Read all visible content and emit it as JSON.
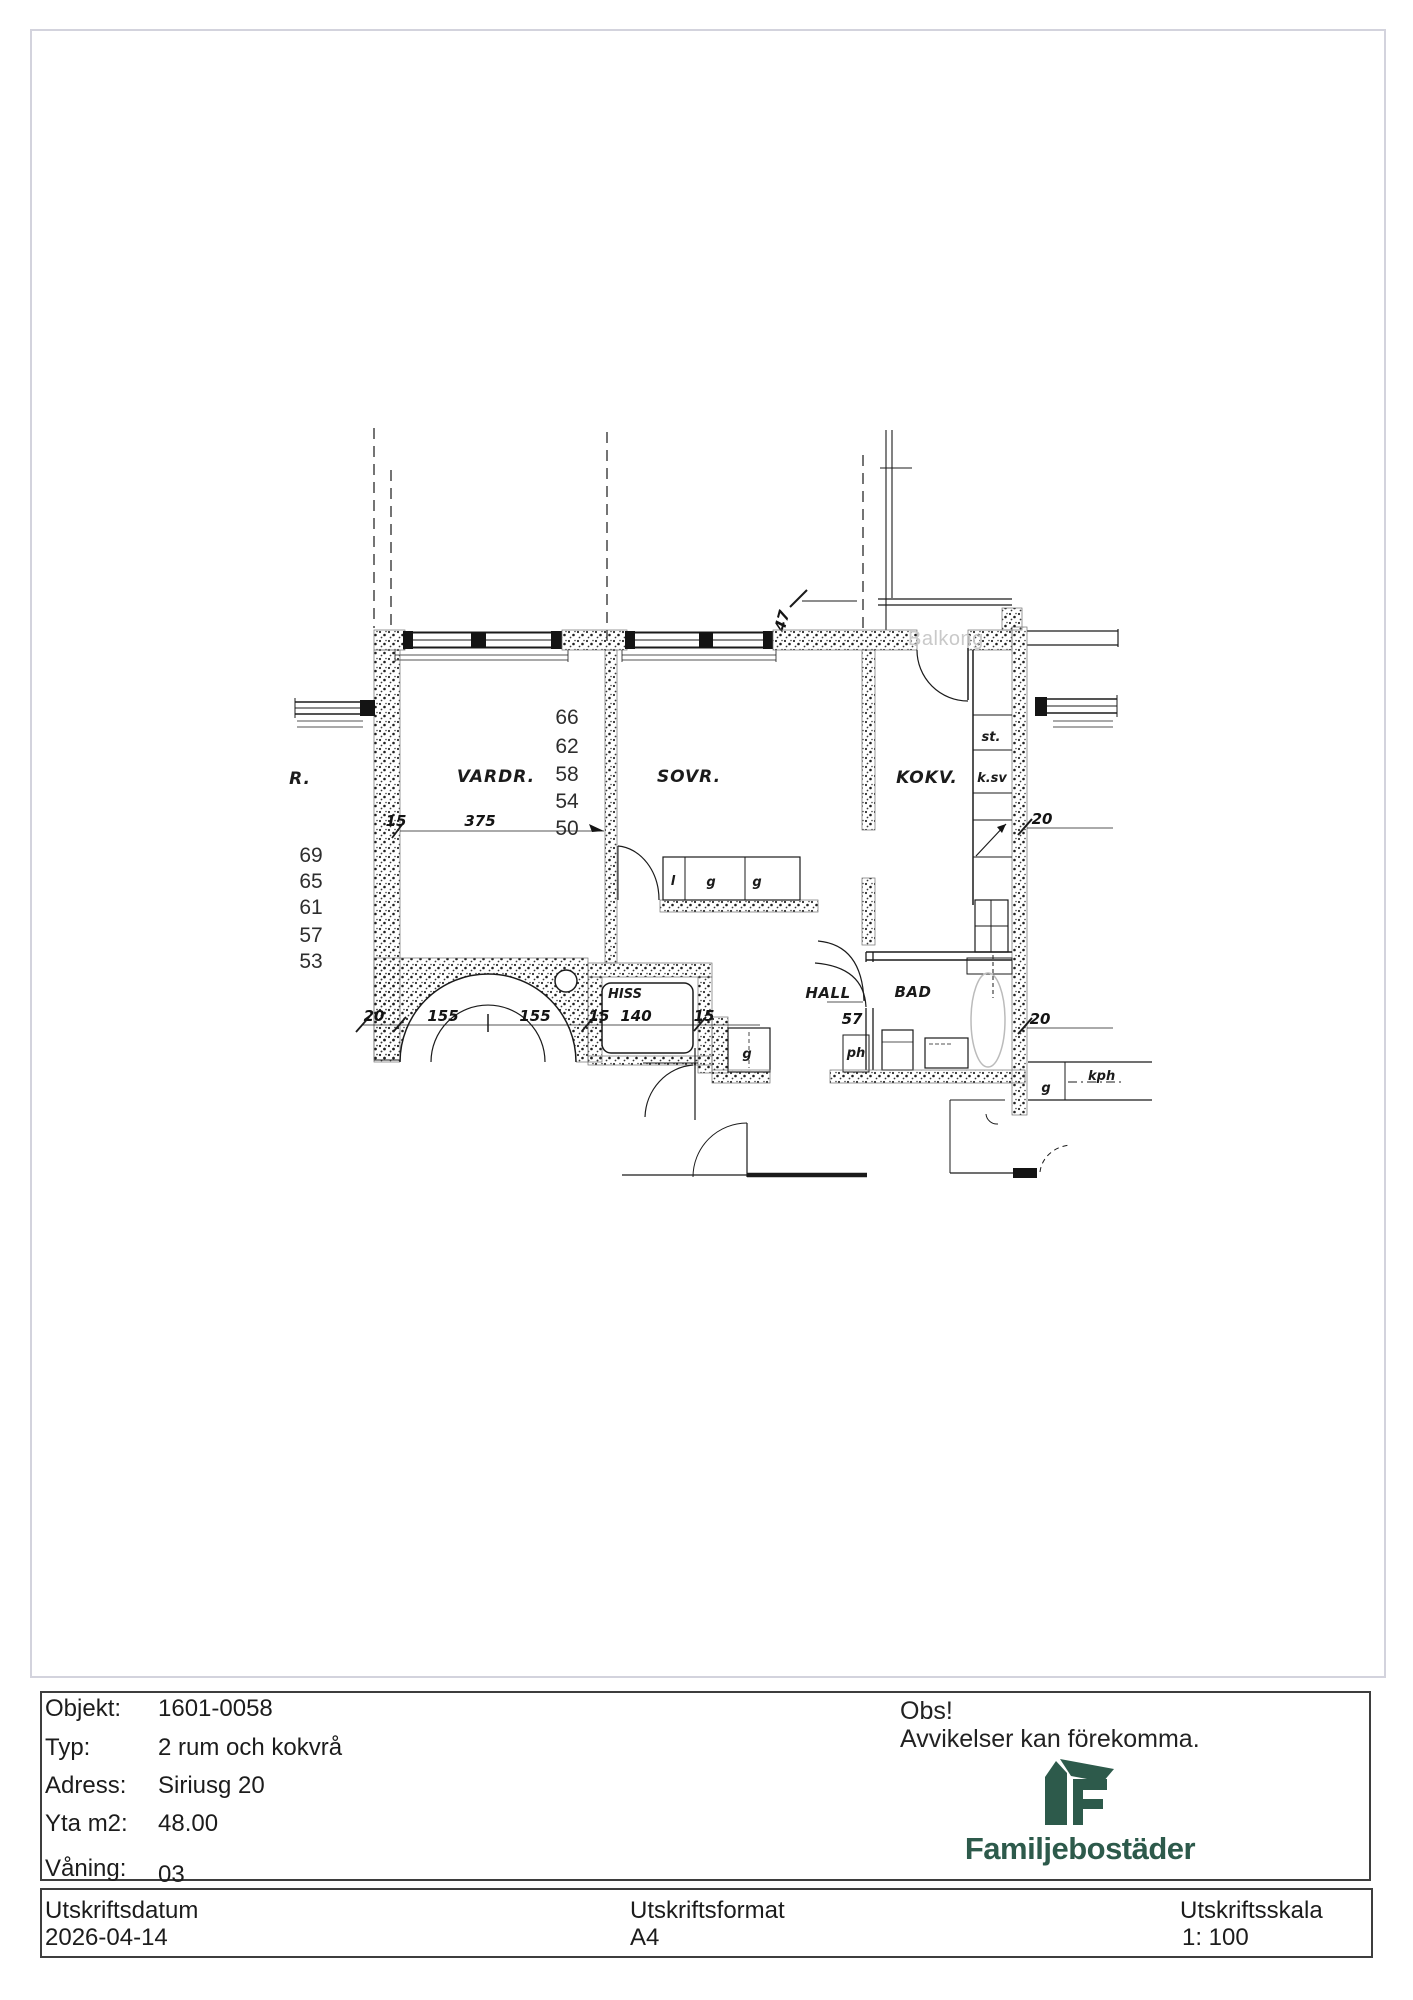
{
  "floorplan": {
    "rooms": {
      "vardr": "VARDR.",
      "sovr": "SOVR.",
      "kokv": "KOKV.",
      "hall": "HALL",
      "bad": "BAD",
      "hiss": "HISS",
      "st": "st.",
      "ksv": "k.sv",
      "balkong": "Balkong",
      "neighbor_clipped": "R."
    },
    "closets": {
      "l": "l",
      "g": "g",
      "ph": "ph",
      "kph": "kph"
    },
    "dims": {
      "d375": "375",
      "d15": "15",
      "d155": "155",
      "d140": "140",
      "d57": "57",
      "d20": "20",
      "d47": "47"
    },
    "col_right": [
      "66",
      "62",
      "58",
      "54",
      "50"
    ],
    "col_left": [
      "69",
      "65",
      "61",
      "57",
      "53"
    ]
  },
  "info": {
    "rows": [
      {
        "label": "Objekt:",
        "value": "1601-0058"
      },
      {
        "label": "Typ:",
        "value": "2 rum och kokvrå"
      },
      {
        "label": "Adress:",
        "value": "Siriusg 20"
      },
      {
        "label": "Yta m2:",
        "value": "48.00"
      },
      {
        "label": "Våning:",
        "value": "03"
      }
    ]
  },
  "notice": {
    "title": "Obs!",
    "text": "Avvikelser kan förekomma."
  },
  "brand": {
    "name": "Familjebostäder",
    "color": "#2d5a4b"
  },
  "print": {
    "columns": [
      {
        "label": "Utskriftsdatum",
        "value": "2026-04-14"
      },
      {
        "label": "Utskriftsformat",
        "value": "A4"
      },
      {
        "label": "Utskriftsskala",
        "value": "1: 100"
      }
    ]
  }
}
